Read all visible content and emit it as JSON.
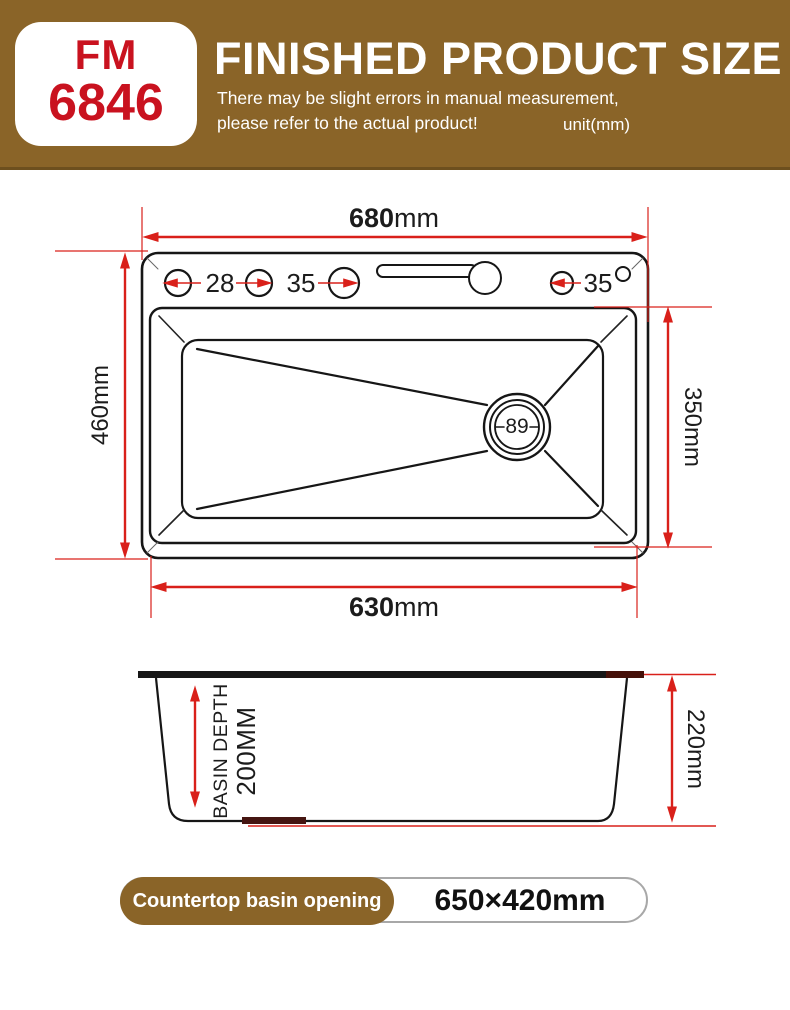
{
  "header": {
    "model_line1": "FM",
    "model_line2": "6846",
    "title": "FINISHED PRODUCT SIZE",
    "note_line1": "There may be slight errors in manual measurement,",
    "note_line2": "please refer to the actual product!",
    "unit_note": "unit(mm)"
  },
  "top_view": {
    "overall_width_value": "680",
    "overall_width_unit": "mm",
    "overall_depth_label": "460mm",
    "inner_width_value": "630",
    "inner_width_unit": "mm",
    "inner_depth_label": "350mm",
    "drain_diameter": "89",
    "hole_label_left": "28",
    "hole_label_mid": "35",
    "hole_label_right": "35"
  },
  "side_view": {
    "basin_depth_label": "BASIN DEPTH",
    "basin_depth_value": "200MM",
    "overall_height_label": "220mm"
  },
  "footer": {
    "label": "Countertop basin opening",
    "value": "650×420mm"
  },
  "colors": {
    "banner_brown": "#8a6428",
    "dimension_red": "#d9201a",
    "model_red": "#c9121f",
    "line_black": "#161616"
  }
}
